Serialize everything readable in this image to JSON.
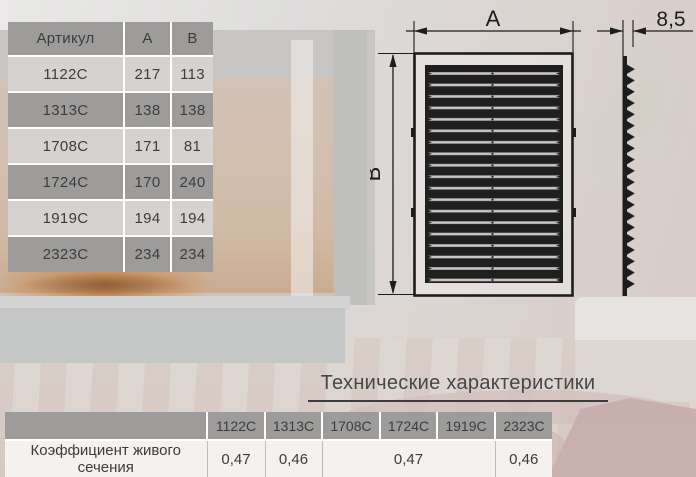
{
  "colors": {
    "line": "#1d1d1d",
    "cell-gray": "#9d9c9b",
    "cell-light": "#d6d2cf",
    "spec-light": "#f4f1ef",
    "ink": "#3d3d3d"
  },
  "dimensions_table": {
    "headers": [
      "Артикул",
      "A",
      "B"
    ],
    "rows": [
      {
        "article": "1122С",
        "a": "217",
        "b": "113"
      },
      {
        "article": "1313С",
        "a": "138",
        "b": "138"
      },
      {
        "article": "1708С",
        "a": "171",
        "b": "81"
      },
      {
        "article": "1724С",
        "a": "170",
        "b": "240"
      },
      {
        "article": "1919С",
        "a": "194",
        "b": "194"
      },
      {
        "article": "2323С",
        "a": "234",
        "b": "234"
      }
    ]
  },
  "drawing": {
    "width_label": "A",
    "height_label": "B",
    "thickness_label": "8,5"
  },
  "specs": {
    "title": "Технические характеристики",
    "row_label": "Коэффициент живого сечения",
    "columns": [
      "1122С",
      "1313С",
      "1708С",
      "1724С",
      "1919С",
      "2323С"
    ],
    "values": [
      {
        "value": "0,47",
        "span": 1
      },
      {
        "value": "0,46",
        "span": 1
      },
      {
        "value": "0,47",
        "span": 3
      },
      {
        "value": "0,46",
        "span": 1
      }
    ]
  }
}
